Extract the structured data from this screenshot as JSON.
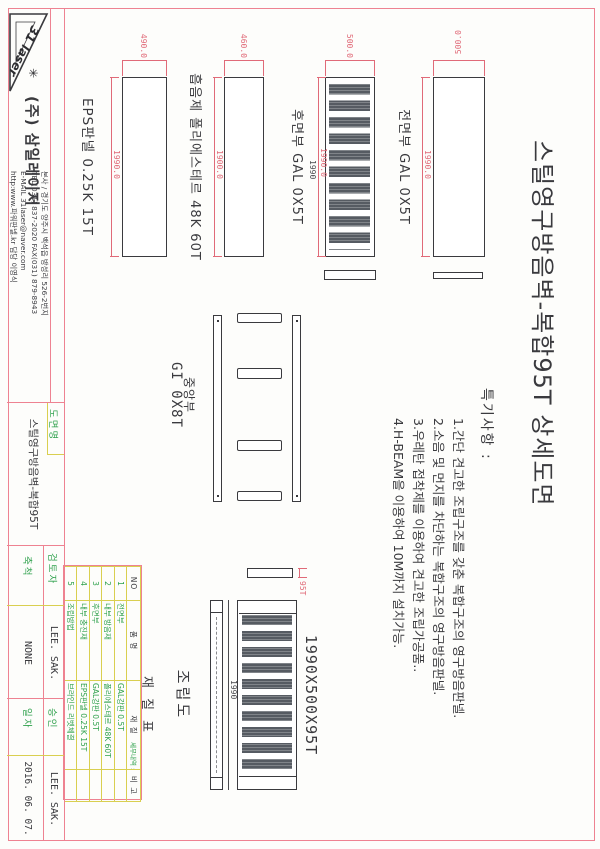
{
  "logo": {
    "brand": "31 laser",
    "company": "(주) 삼일레이저",
    "contact_lines": [
      "본사 / 경기도 양주시 백석읍 방성리 526-2번지",
      "TEL(031) 837-2020 FAX(031) 879-8943",
      "E-MAIL  31laser@naver.com",
      "http:www.파워판넬.kr 담당 이영식"
    ]
  },
  "title": "스틸영구방음벽-복합95T 상세도면",
  "notes": {
    "heading": "특기사항 :",
    "items": [
      "1.간단 견고한 조립구조를 갖춘 복합구조의 영구방음판넬.",
      "2.소음 및 먼지를 차단하는 복합구조의 영구방음판넬.",
      "3.우레탄 접착제를 이용하여 견고한 조립가공품..",
      "4.H-BEAM을 이용하여 10M까지 설치가능."
    ]
  },
  "panels": [
    {
      "name": "전면부 GAL 0X5T",
      "width_dim": "500.0",
      "length_dim": "1990.0"
    },
    {
      "name": "후면부 GAL 0X5T",
      "width_dim": "500.0",
      "length_dim": "1990.0",
      "length_dim2": "1990",
      "slot_count": 10
    },
    {
      "name": "흡음제 폴리에스테르 48K 60T",
      "width_dim": "460.0",
      "length_dim": "1900.0"
    },
    {
      "name": "EPS판넬 0.25K 15T",
      "width_dim": "490.0",
      "length_dim": "1990.0"
    }
  ],
  "center_part": {
    "name_line1": "중앙부",
    "name_line2": "GI 0X8T"
  },
  "assembly": {
    "label": "조립도",
    "size_label": "1990X500X95T",
    "length_dim": "1990",
    "thickness_dim": "95T",
    "slot_count": 10
  },
  "material_table": {
    "title": "재 질 표",
    "note": "세부내역 :",
    "headers": [
      "NO",
      "품 명",
      "재 질",
      "비 고"
    ],
    "rows": [
      [
        "1",
        "전면부",
        "GAL강판 0.5T",
        ""
      ],
      [
        "2",
        "내부 방음재",
        "폴리에스테르 48K 60T",
        ""
      ],
      [
        "3",
        "후면부",
        "GAL강판 0.5T",
        ""
      ],
      [
        "4",
        "내부 충진재",
        "EPS판넬 0.25K 15T",
        ""
      ],
      [
        "5",
        "조립방법",
        "브라인드 리벳체결",
        ""
      ]
    ]
  },
  "title_block": {
    "drawing_name_label": "도면명",
    "drawing_name": "스틸영구방음벽-복합95T",
    "reviewer_label": "검토자",
    "reviewer": "LEE. SAK.",
    "approver_label": "승인",
    "approver": "LEE. SAK.",
    "scale_label": "축척",
    "scale": "NONE",
    "date_label": "일자",
    "date": "2016. 06. 07."
  },
  "colors": {
    "border_pink": "#ee8291",
    "grid_yellow": "#d9cf50",
    "text_green": "#2fa14c",
    "dim_pink": "#e06a78",
    "line_dark": "#3a3a3e",
    "slot_fill": "#565b62"
  }
}
